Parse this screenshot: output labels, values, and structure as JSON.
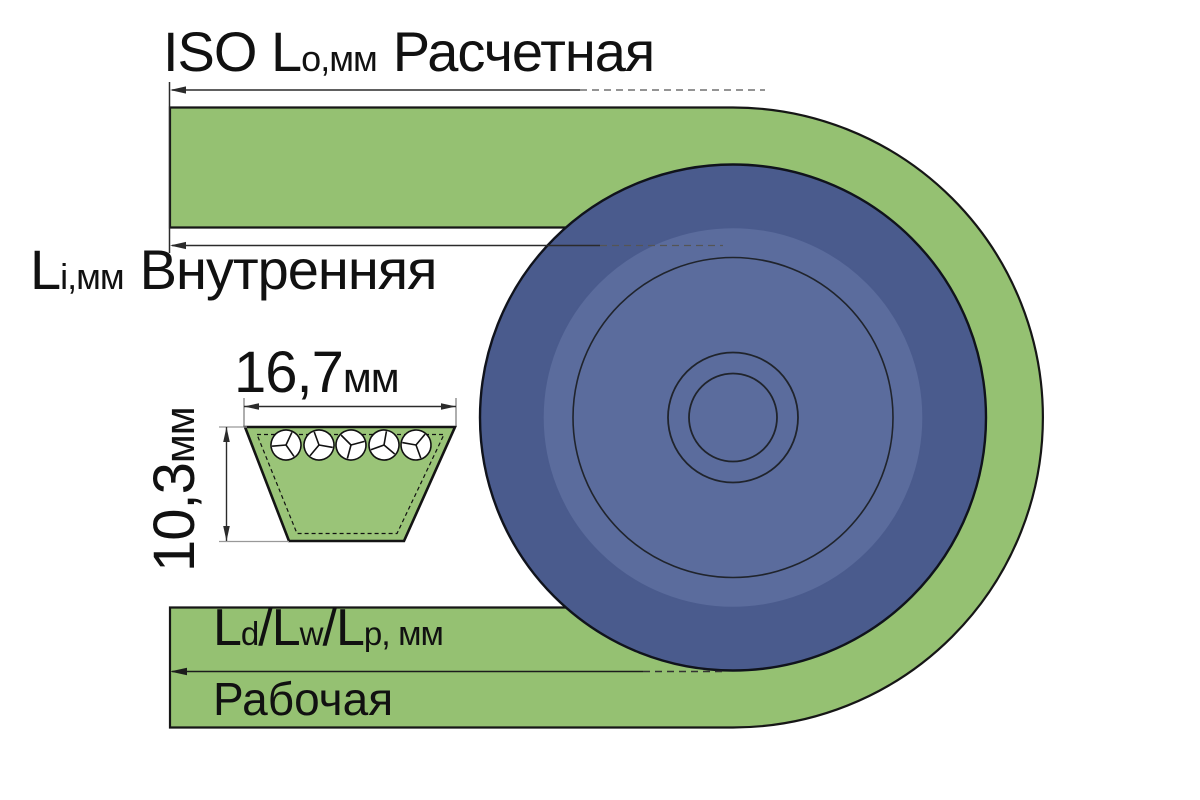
{
  "diagram": "v-belt-pulley-length-designations",
  "colors": {
    "belt_green": "#95C172",
    "trapezoid_green": "#9AC478",
    "pulley_rim_blue": "#4A5B8D",
    "pulley_disc_blue": "#5B6C9D",
    "cord_fill": "#FFFFFF",
    "outline_black": "#161616",
    "dim_line": "#2B2B2B"
  },
  "labels": {
    "outer_length": {
      "main": "ISO L",
      "sub": "o",
      "units": ",мм",
      "name": "Расчетная"
    },
    "inner_length": {
      "main": "L",
      "sub": "i",
      "units": ",мм",
      "name": "Внутренняя"
    },
    "belt_width": {
      "value": "16,7",
      "units": "мм"
    },
    "belt_height": {
      "value": "10,3",
      "units": "мм"
    },
    "pitch_length": {
      "l1": "L",
      "sub1": "d",
      "l2": "/L",
      "sub2": "w",
      "l3": "/L",
      "sub3": "p",
      "tail": ", мм"
    },
    "working_length": {
      "name": "Рабочая"
    }
  },
  "dimensions": {
    "belt_top_width_mm": "16,7",
    "belt_height_mm": "10,3"
  }
}
